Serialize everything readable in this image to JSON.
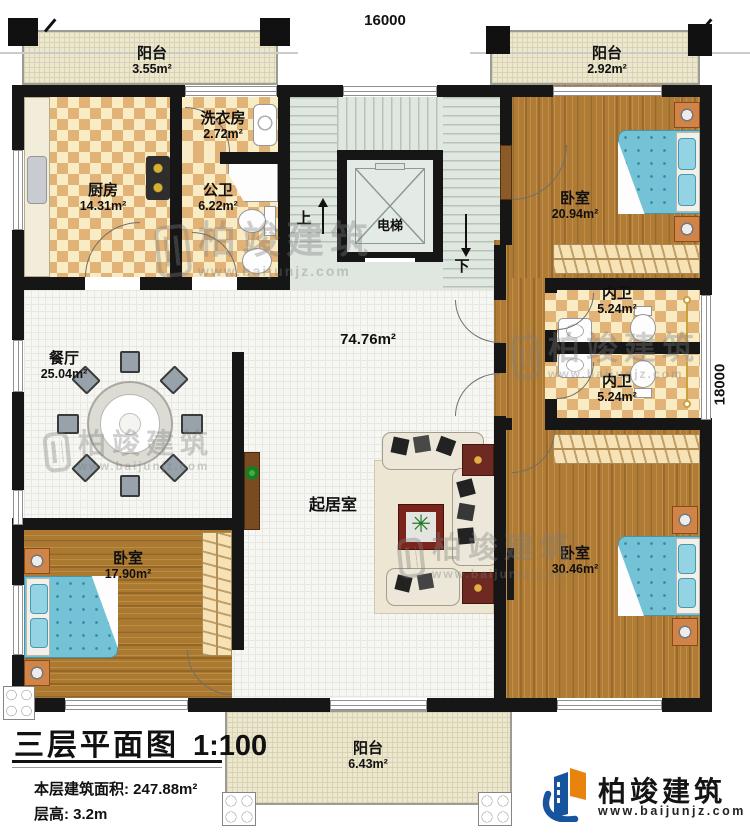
{
  "plan": {
    "dimensions": {
      "top": "16000",
      "right": "18000"
    },
    "stairs": {
      "up": "上",
      "down": "下"
    },
    "elevator": "电梯",
    "rooms": {
      "balcony_tl": {
        "label": "阳台",
        "area": "3.55m²"
      },
      "laundry": {
        "label": "洗衣房",
        "area": "2.72m²"
      },
      "kitchen": {
        "label": "厨房",
        "area": "14.31m²"
      },
      "bath_public": {
        "label": "公卫",
        "area": "6.22m²"
      },
      "balcony_tr": {
        "label": "阳台",
        "area": "2.92m²"
      },
      "bedroom1": {
        "label": "卧室",
        "area": "20.94m²"
      },
      "ensuite1": {
        "label": "内卫",
        "area": "5.24m²"
      },
      "ensuite2": {
        "label": "内卫",
        "area": "5.24m²"
      },
      "dining": {
        "label": "餐厅",
        "area": "25.04m²"
      },
      "hall": {
        "area": "74.76m²"
      },
      "living": {
        "label": "起居室"
      },
      "bedroom2": {
        "label": "卧室",
        "area": "17.90m²"
      },
      "bedroom3": {
        "label": "卧室",
        "area": "30.46m²"
      },
      "balcony_b": {
        "label": "阳台",
        "area": "6.43m²"
      }
    }
  },
  "titleblock": {
    "title": "三层平面图",
    "scale": "1:100",
    "area_label": "本层建筑面积:",
    "area_value": "247.88m²",
    "height_label": "层高:",
    "height_value": "3.2m"
  },
  "brand": {
    "name": "柏竣建筑",
    "url": "www.baijunjz.com"
  },
  "watermark": {
    "name": "柏竣建筑",
    "url": "www.baijunjz.com"
  },
  "colors": {
    "wall": "#161616",
    "wood_floor": "#b07c35",
    "tile_accent": "#e2b377",
    "bed_blue": "#74c2d6",
    "brand_blue": "#17549e",
    "brand_orange": "#e8830d"
  }
}
